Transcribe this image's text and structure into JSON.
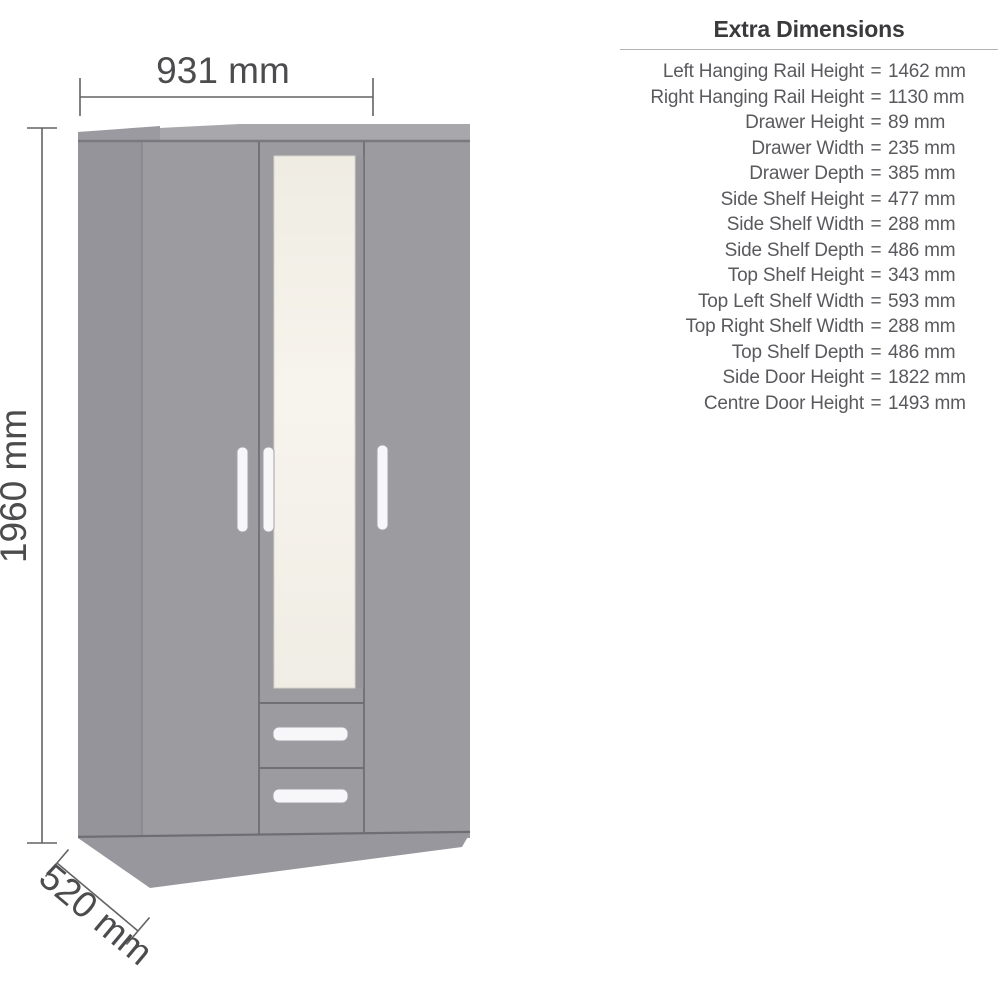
{
  "diagram": {
    "width_label": "931 mm",
    "height_label": "1960 mm",
    "depth_label": "520 mm",
    "colors": {
      "door_grey": "#9c9ba0",
      "side_panel_grey": "#95949a",
      "top_panel_grey": "#a8a7ac",
      "plinth_grey": "#98979d",
      "panel_gap_line": "#74737a",
      "mirror_cream": "#f4f1e9",
      "handle_white": "#f7f7f9",
      "dimension_line": "#636366",
      "dimension_text": "#4c4c4e"
    }
  },
  "extra_dimensions": {
    "title": "Extra Dimensions",
    "equals_sign": "=",
    "rows": [
      {
        "label": "Left Hanging Rail Height",
        "value": "1462 mm"
      },
      {
        "label": "Right Hanging Rail Height",
        "value": "1130 mm"
      },
      {
        "label": "Drawer Height",
        "value": "89 mm"
      },
      {
        "label": "Drawer Width",
        "value": "235 mm"
      },
      {
        "label": "Drawer Depth",
        "value": "385 mm"
      },
      {
        "label": "Side Shelf Height",
        "value": "477 mm"
      },
      {
        "label": "Side Shelf Width",
        "value": "288 mm"
      },
      {
        "label": "Side Shelf Depth",
        "value": "486 mm"
      },
      {
        "label": "Top Shelf Height",
        "value": "343 mm"
      },
      {
        "label": "Top Left Shelf Width",
        "value": "593 mm"
      },
      {
        "label": "Top Right Shelf Width",
        "value": "288 mm"
      },
      {
        "label": "Top Shelf Depth",
        "value": "486 mm"
      },
      {
        "label": "Side Door Height",
        "value": "1822 mm"
      },
      {
        "label": "Centre Door Height",
        "value": "1493 mm"
      }
    ]
  }
}
